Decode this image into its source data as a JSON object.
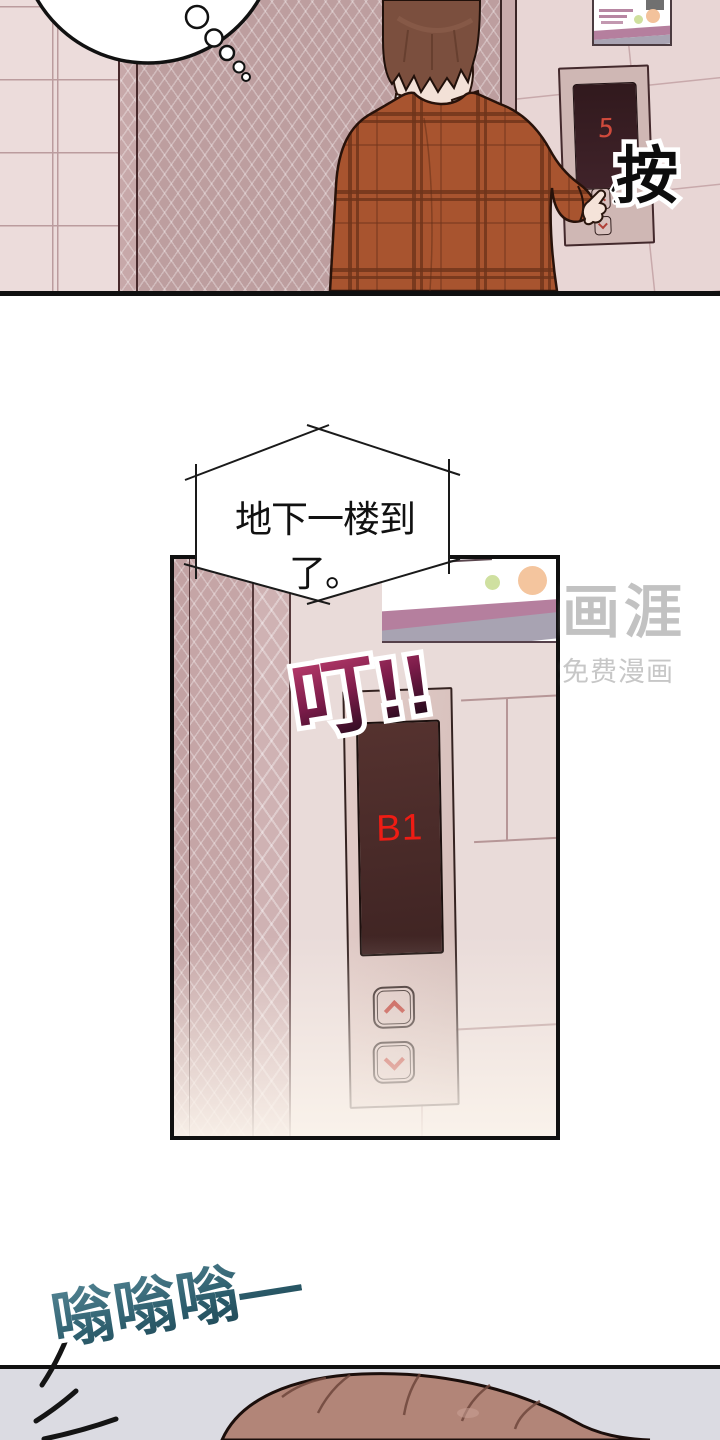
{
  "comic": {
    "panel1": {
      "name": "elevator-hall",
      "floor_display": "5",
      "sfx_press": "按"
    },
    "speech": {
      "text": "地下一楼到了。"
    },
    "panel2": {
      "name": "elevator-arrival",
      "sfx_ding": "叮!!",
      "floor_display": "B1"
    },
    "panel3": {
      "sfx_buzz": "嗡嗡嗡—"
    },
    "watermark": {
      "logo": "画涯",
      "tagline": "免费漫画"
    },
    "icons": {
      "call_up": "chevron-up-icon",
      "call_down": "chevron-down-icon",
      "panel_up": "chevron-up-icon",
      "panel_down": "chevron-down-icon"
    },
    "colors": {
      "display_digit_red": "#ef1c14",
      "call_digit_red": "#cf4a3c",
      "sfx_ding_top": "#b63a6a",
      "sfx_ding_bottom": "#1e0818",
      "sfx_buzz_teal": "#2d5e6d",
      "jacket_plaid": "#a8542f",
      "tile_wall": "#ecdcdb",
      "herringbone_wall": "#bd9e9f",
      "panel3_background": "#dbdbe2"
    }
  }
}
